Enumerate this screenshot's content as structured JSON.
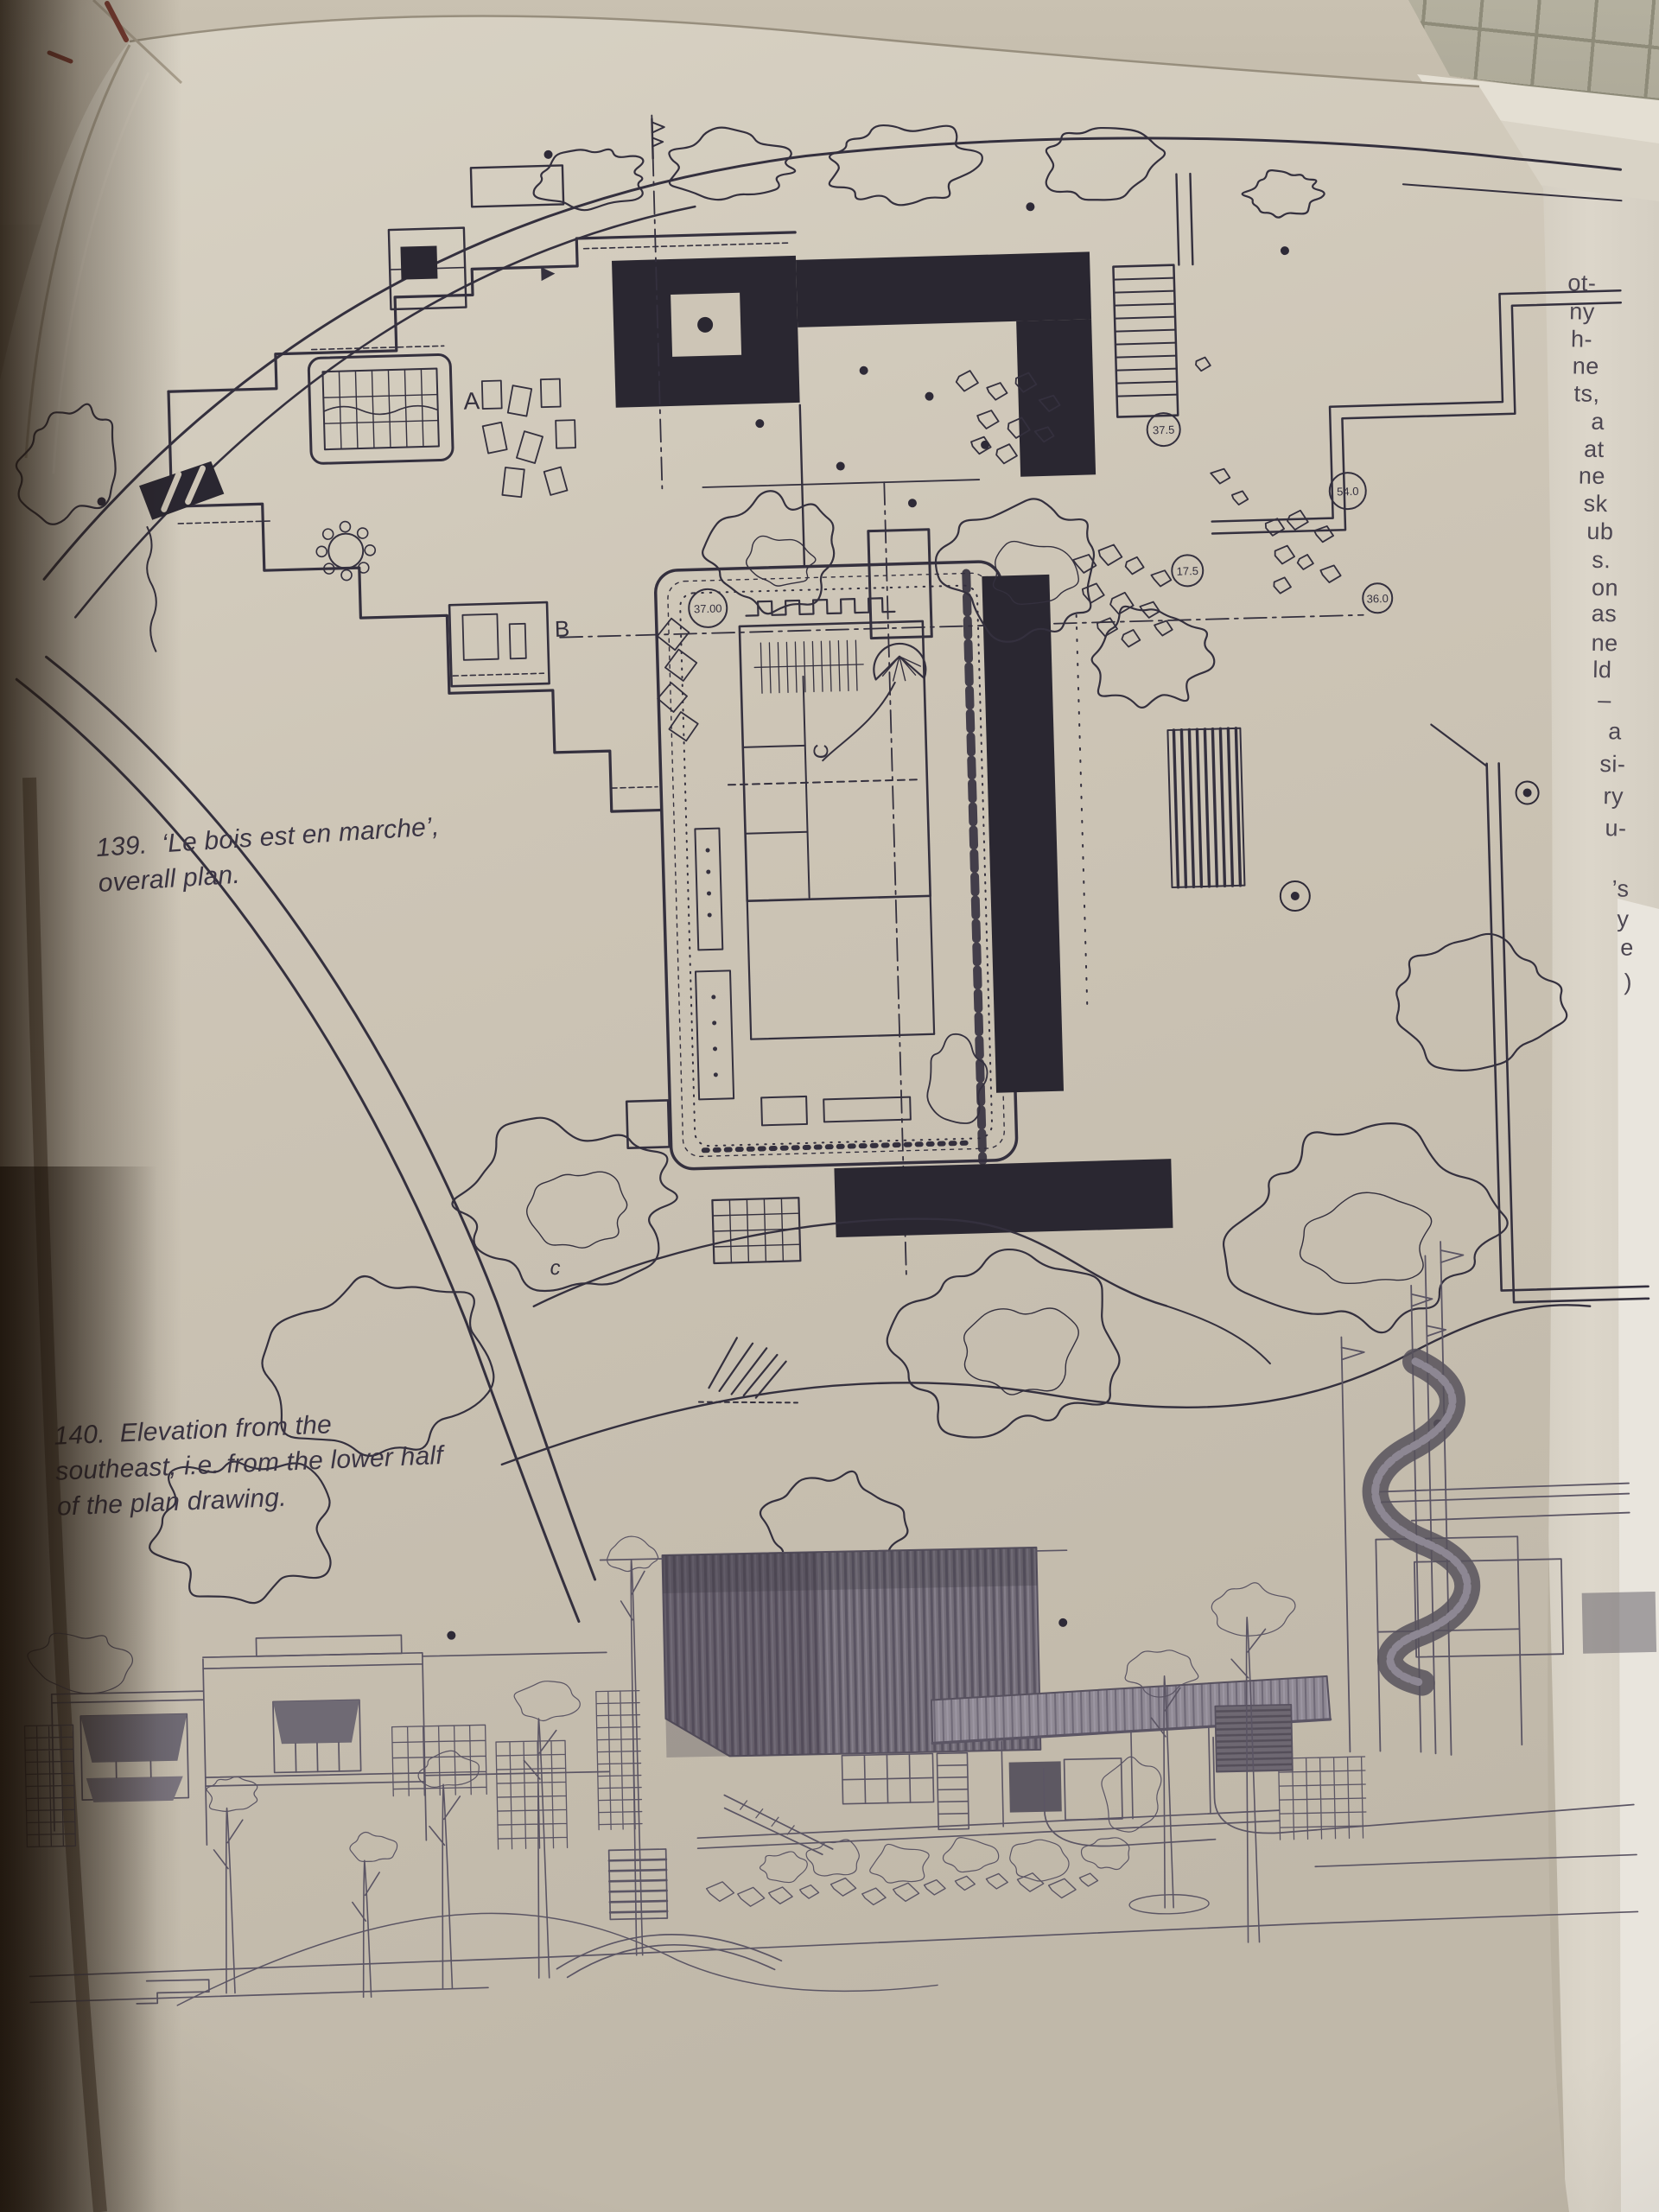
{
  "page": {
    "fig139": {
      "lines": [
        "139.  ‘Le bois est en marche’,",
        "overall plan."
      ]
    },
    "fig140": {
      "lines": [
        "140.  Elevation from the",
        "southeast, i.e. from the lower half",
        "of the plan drawing."
      ]
    },
    "plan_labels": {
      "a": "A",
      "b": "B",
      "c_small": "c",
      "c_large": "C"
    },
    "spot_levels": {
      "s1": "37.00",
      "s2": "37.5",
      "s3": "17.5",
      "s4": "54.0",
      "s5": "36.0"
    },
    "edge_fragments": [
      "ot-",
      "ny",
      "h-",
      "ne",
      "ts,",
      "a",
      "at",
      "ne",
      "sk",
      "ub",
      "s.",
      "on",
      "as",
      "ne",
      "ld",
      "–",
      "a",
      "si-",
      "ry",
      "u-",
      "’s",
      "y",
      "e",
      ")"
    ]
  }
}
